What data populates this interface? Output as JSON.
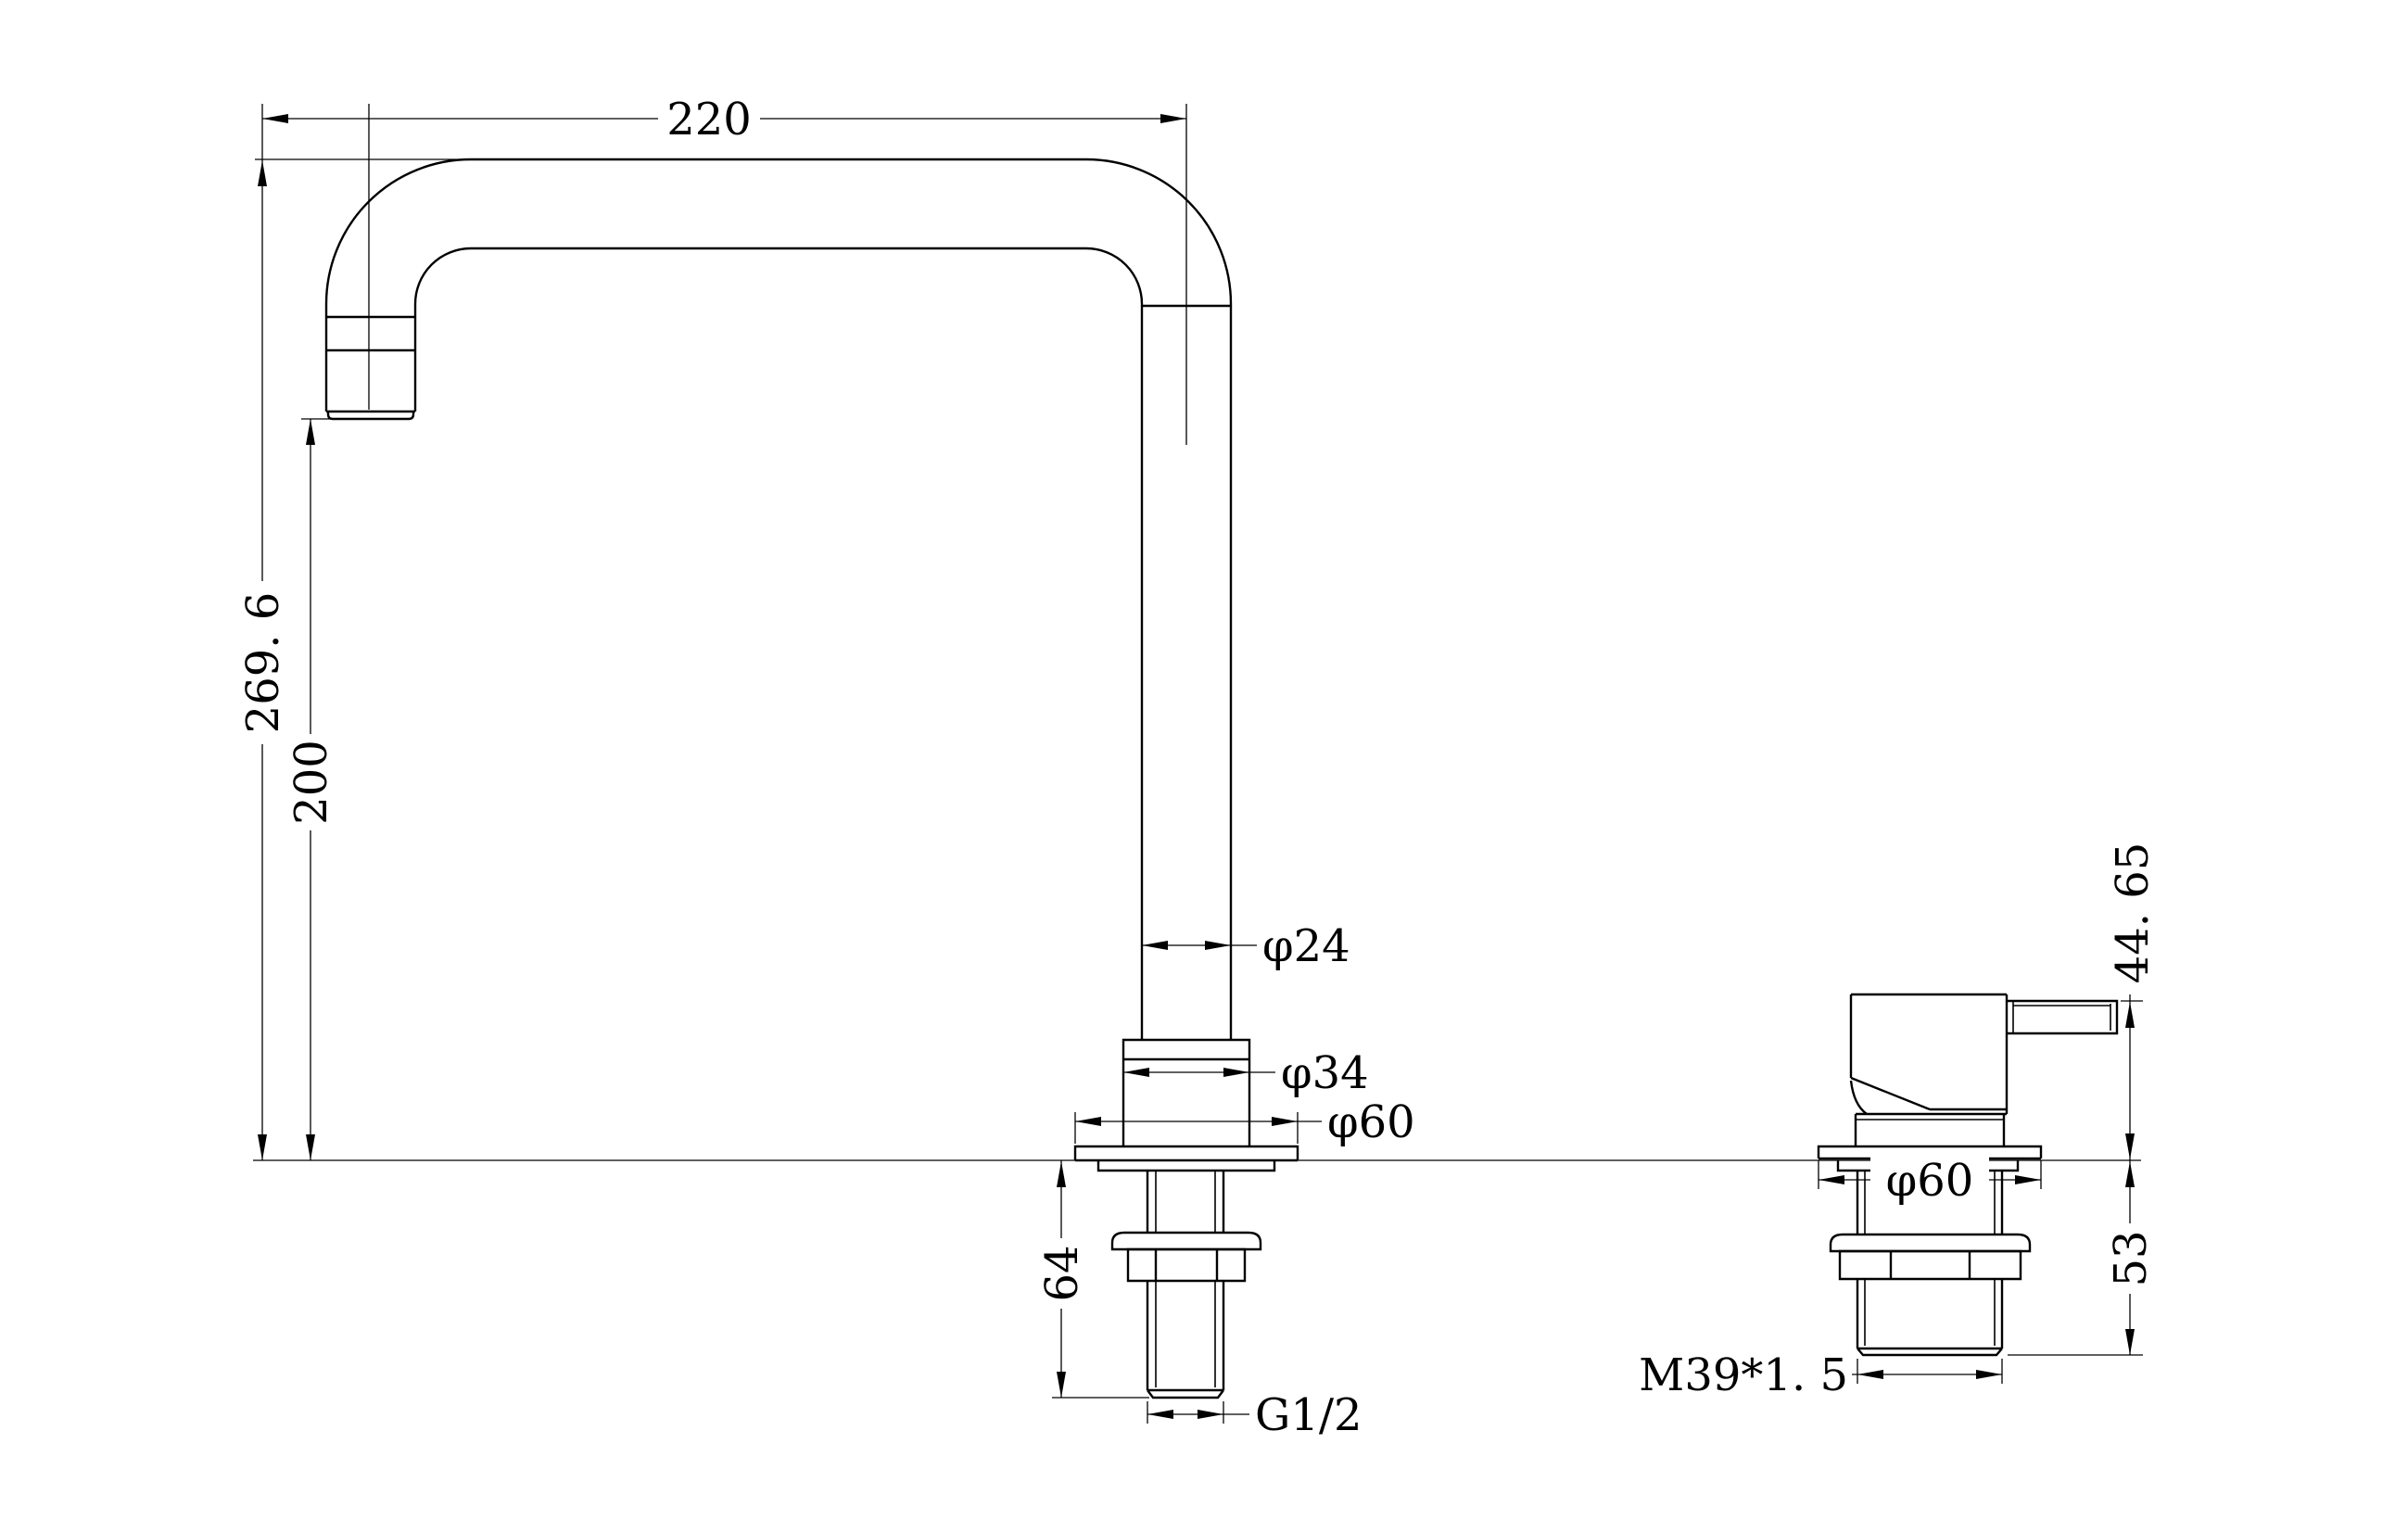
{
  "page": {
    "background_color": "#ffffff",
    "line_color": "#000000",
    "description": "faucet-technical-drawing"
  },
  "dims": {
    "top_width": "220",
    "total_height": "269. 6",
    "spout_height": "200",
    "spout_diameter": "φ24",
    "column_diameter": "φ34",
    "flange_diameter": "φ60",
    "under_counter_depth": "64",
    "outlet_thread": "G1/2",
    "handle_height": "44. 65",
    "side_flange_diameter": "φ60",
    "shank_length": "53",
    "mounting_thread": "M39*1. 5"
  }
}
